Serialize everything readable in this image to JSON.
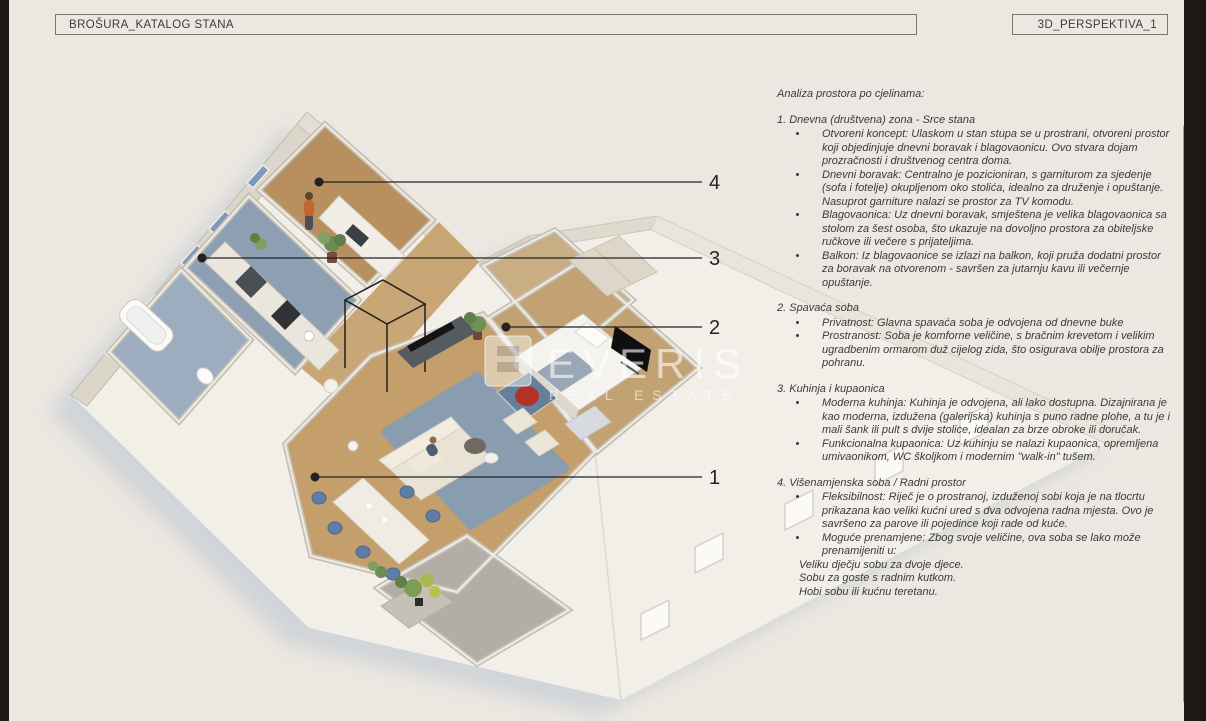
{
  "page": {
    "header_left": "BROŠURA_KATALOG STANA",
    "header_right": "3D_PERSPEKTIVA_1"
  },
  "watermark": {
    "brand": "EVERIS",
    "tagline": "REAL ESTATE"
  },
  "callouts": [
    {
      "label": "1"
    },
    {
      "label": "2"
    },
    {
      "label": "3"
    },
    {
      "label": "4"
    }
  ],
  "analysis": {
    "title": "Analiza prostora po cjelinama:",
    "sections": [
      {
        "heading": "1. Dnevna (društvena) zona - Srce stana",
        "bullets": [
          "Otvoreni koncept: Ulaskom u stan stupa se u prostrani, otvoreni prostor koji objedinjuje dnevni boravak i blagovaonicu. Ovo stvara dojam prozračnosti i društvenog centra doma.",
          "Dnevni boravak: Centralno je pozicioniran, s garniturom za sjedenje (sofa i fotelje) okupljenom oko stolića, idealno za druženje i opuštanje. Nasuprot garniture nalazi se prostor za TV komodu.",
          "Blagovaonica: Uz dnevni boravak, smještena je velika blagovaonica sa stolom za šest osoba, što ukazuje na dovoljno prostora za obiteljske ručkove ili večere s prijateljima.",
          "Balkon: Iz blagovaonice se izlazi na balkon, koji pruža dodatni prostor za boravak na otvorenom - savršen za jutarnju kavu ili večernje opuštanje."
        ],
        "extra_lines": []
      },
      {
        "heading": "2. Spavaća soba",
        "bullets": [
          "Privatnost: Glavna spavaća soba je odvojena od dnevne buke",
          "Prostranost: Soba je komforne veličine, s bračnim krevetom i velikim ugradbenim ormarom duž cijelog zida, što osigurava obilje prostora za pohranu."
        ],
        "extra_lines": []
      },
      {
        "heading": "3. Kuhinja i kupaonica",
        "bullets": [
          "Moderna kuhinja: Kuhinja je odvojena, ali lako dostupna. Dizajnirana je kao moderna, izdužena (galerijska) kuhinja s puno radne plohe, a tu je i mali šank ili pult s dvije stolice, idealan za brze obroke ili doručak.",
          "Funkcionalna kupaonica: Uz kuhinju se nalazi kupaonica, opremljena umivaonikom, WC školjkom i modernim \"walk-in\" tušem."
        ],
        "extra_lines": []
      },
      {
        "heading": "4. Višenamjenska soba / Radni prostor",
        "bullets": [
          "Fleksibilnost: Riječ je o prostranoj, izduženoj sobi koja je na tlocrtu prikazana kao veliki kućni ured s dva odvojena radna mjesta. Ovo je savršeno za parove ili pojedince koji rade od kuće.",
          "Moguće prenamjene: Zbog svoje veličine, ova soba se lako može prenamijeniti u:"
        ],
        "extra_lines": [
          "Veliku dječju sobu za dvoje djece.",
          "Sobu za goste s radnim kutkom.",
          "Hobi sobu ili kućnu teretanu."
        ]
      }
    ]
  },
  "colors": {
    "page_bg": "#ECE7E0",
    "edge_dark": "#1B1816",
    "text": "#3A3A3A",
    "border": "#7A756D",
    "callout": "#222222",
    "scrollbar": "#A29B92",
    "window_glass": "#7D98BD",
    "wood_floor": "#C49E6B",
    "rug_blue": "#8A9DB0",
    "chair_blue": "#5E7CA8",
    "artwork_red": "#B23326",
    "facade": "#F2EFE9"
  }
}
